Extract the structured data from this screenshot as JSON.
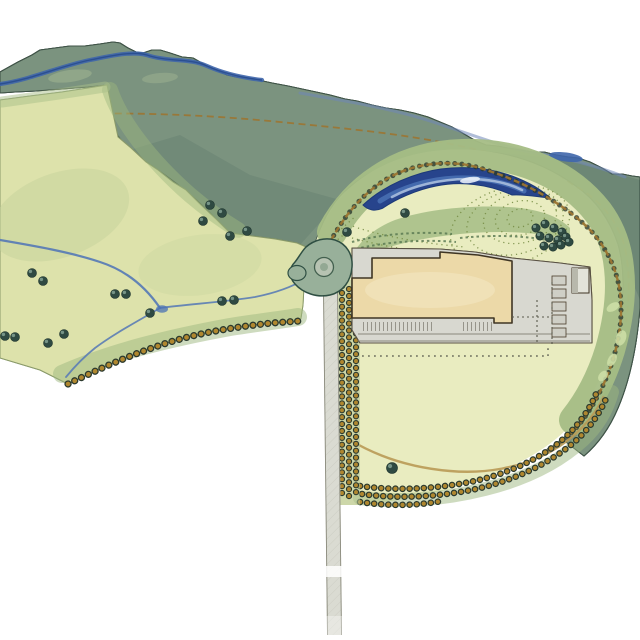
{
  "palette": {
    "paper": "#ffffff",
    "woodland_base": "#7b937f",
    "woodland_hatch": "#34544a",
    "woodland_edge": "#3f5347",
    "river_blue": "#3f66ab",
    "trail_ochre": "#9c7532",
    "field_base": "#dde2ab",
    "field_wash": "#9db77f",
    "stream_blue": "#5b7db5",
    "tree_dark": "#2f4a42",
    "tree_highlight": "#8fae9f",
    "hedgerow_ochre": "#b0872f",
    "hedgerow_ring": "#2c3a2e",
    "mound_green": "#a5bd85",
    "pond_dark": "#27448c",
    "pond_mid": "#4a71b4",
    "pond_light": "#a9bedd",
    "lawn": "#e9ecc0",
    "contour_olive": "#72883f",
    "pavement": "#d8d8d0",
    "pavement_hatch": "#b3b4a8",
    "outline_sepia": "#3f3524",
    "building_tan": "#ecd9a8",
    "road_gray": "#dadbd2",
    "road_edge": "#8b8b7d",
    "roundabout_surface": "#98b09a",
    "annex_gray": "#e3e3da"
  },
  "trees": {
    "field": [
      [
        210,
        205
      ],
      [
        222,
        213
      ],
      [
        203,
        221
      ],
      [
        230,
        236
      ],
      [
        247,
        231
      ],
      [
        32,
        273
      ],
      [
        43,
        281
      ],
      [
        115,
        294
      ],
      [
        126,
        294
      ],
      [
        150,
        313
      ],
      [
        222,
        301
      ],
      [
        234,
        300
      ],
      [
        5,
        336
      ],
      [
        15,
        337
      ],
      [
        48,
        343
      ],
      [
        64,
        334
      ]
    ],
    "pond_side": [
      [
        405,
        213
      ],
      [
        347,
        232
      ]
    ],
    "cluster": [
      [
        536,
        228
      ],
      [
        545,
        224
      ],
      [
        554,
        228
      ],
      [
        562,
        232
      ],
      [
        540,
        236
      ],
      [
        549,
        238
      ],
      [
        558,
        240
      ],
      [
        566,
        237
      ],
      [
        544,
        246
      ],
      [
        553,
        247
      ],
      [
        561,
        245
      ],
      [
        569,
        242
      ]
    ],
    "lawn": [
      [
        392,
        468
      ]
    ]
  },
  "features": {
    "woodland_belt": "woodland-belt",
    "river": "river",
    "upper_trail": "upper-trail",
    "pasture_field": "pasture-field",
    "streams": "streams",
    "hedgerow": "hedgerow-with-trees",
    "development_oval": "development-platform",
    "lake": "crescent-lake",
    "mounds": "landform-mounds",
    "building": "factory-building",
    "service_yard": "service-yard",
    "loading_docks": "loading-docks",
    "parking": "parking-bays",
    "expansion_line": "future-expansion-dashed-line",
    "lawn": "lawn-oval",
    "tree_belt": "tree-belt",
    "avenue": "avenue-planting",
    "roundabout": "roundabout",
    "access_road": "access-road"
  }
}
